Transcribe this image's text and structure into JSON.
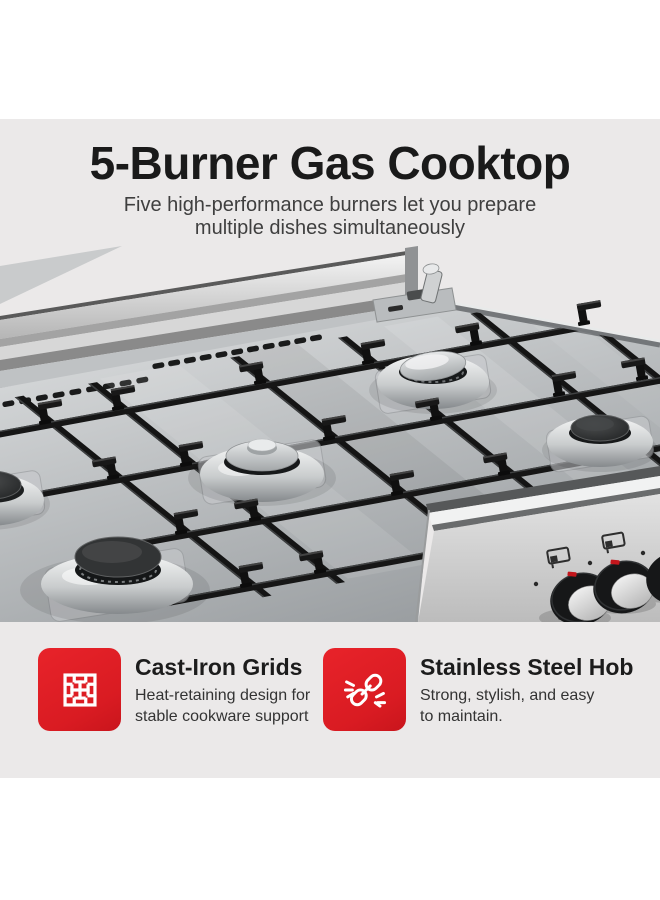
{
  "page": {
    "background": "#FFFFFF",
    "band_background": "#EBE9E9"
  },
  "header": {
    "title": "5-Burner Gas Cooktop",
    "subtitle_line1": "Five high-performance burners let you prepare",
    "subtitle_line2": "multiple dishes simultaneously"
  },
  "product_image": {
    "name": "cooktop-render"
  },
  "features": [
    {
      "icon": "grate-icon",
      "title": "Cast-Iron Grids",
      "desc_line1": "Heat-retaining design for",
      "desc_line2": "stable cookware support"
    },
    {
      "icon": "chain-link-icon",
      "title": "Stainless Steel Hob",
      "desc_line1": "Strong, stylish, and easy",
      "desc_line2": "to maintain."
    }
  ],
  "colors": {
    "accent_red": "#E2232A",
    "title_text": "#1A1A1A",
    "subtitle_text": "#3F3F3F",
    "body_text": "#333333"
  }
}
